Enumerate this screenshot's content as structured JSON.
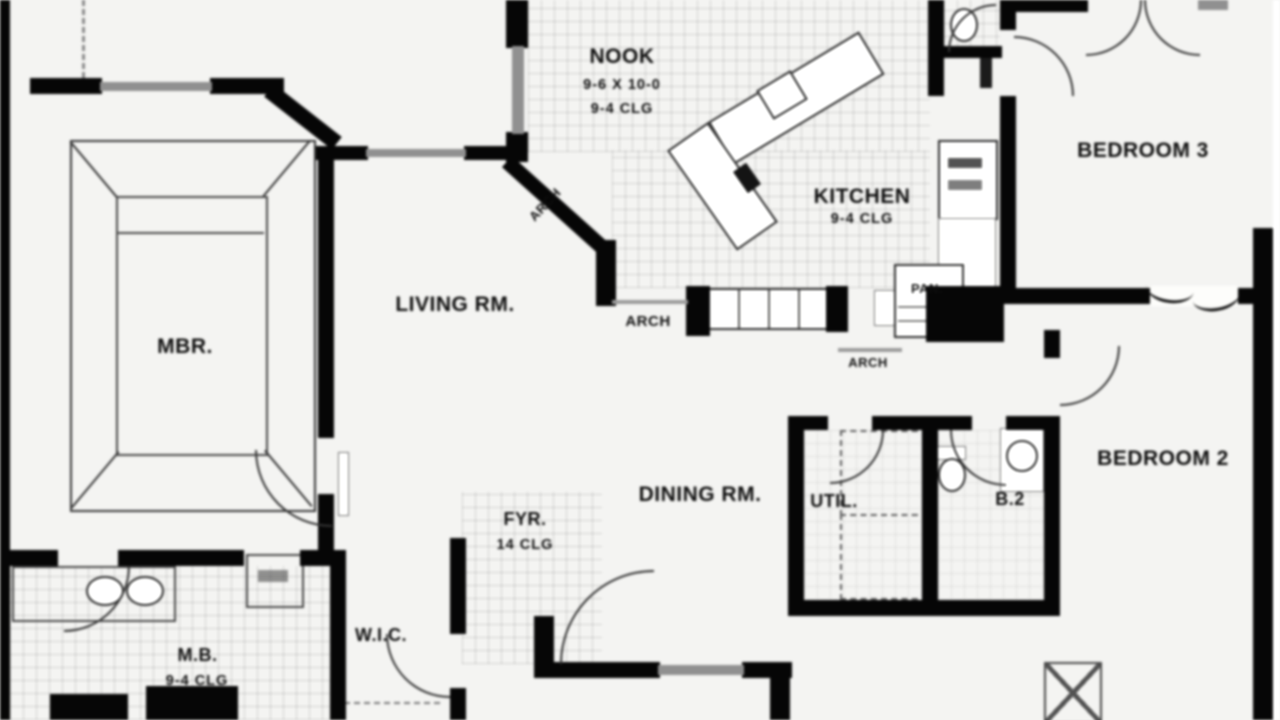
{
  "title": "House floor plan",
  "rooms": {
    "nook": {
      "label": "NOOK",
      "size": "9-6 X 10-0",
      "clg": "9-4 CLG"
    },
    "kitchen": {
      "label": "KITCHEN",
      "clg": "9-4 CLG"
    },
    "bedroom3": {
      "label": "BEDROOM 3"
    },
    "living": {
      "label": "LIVING RM."
    },
    "mbr": {
      "label": "MBR."
    },
    "dining": {
      "label": "DINING RM."
    },
    "util": {
      "label": "UTIL."
    },
    "bath2": {
      "label": "B.2"
    },
    "bedroom2": {
      "label": "BEDROOM 2"
    },
    "foyer": {
      "label": "FYR.",
      "clg": "14 CLG"
    },
    "wic": {
      "label": "W.I.C."
    },
    "mbath": {
      "label": "M.B.",
      "clg": "9-4 CLG"
    },
    "pantry": {
      "label": "PAN."
    }
  },
  "annotations": {
    "arch_nook": "ARCH",
    "arch_kitchen": "ARCH",
    "arch_hall": "ARCH"
  },
  "colors": {
    "wall": "#0f0f0f",
    "window": "#8f8f8f",
    "paper": "#f4f4f2",
    "ink": "#161616"
  }
}
